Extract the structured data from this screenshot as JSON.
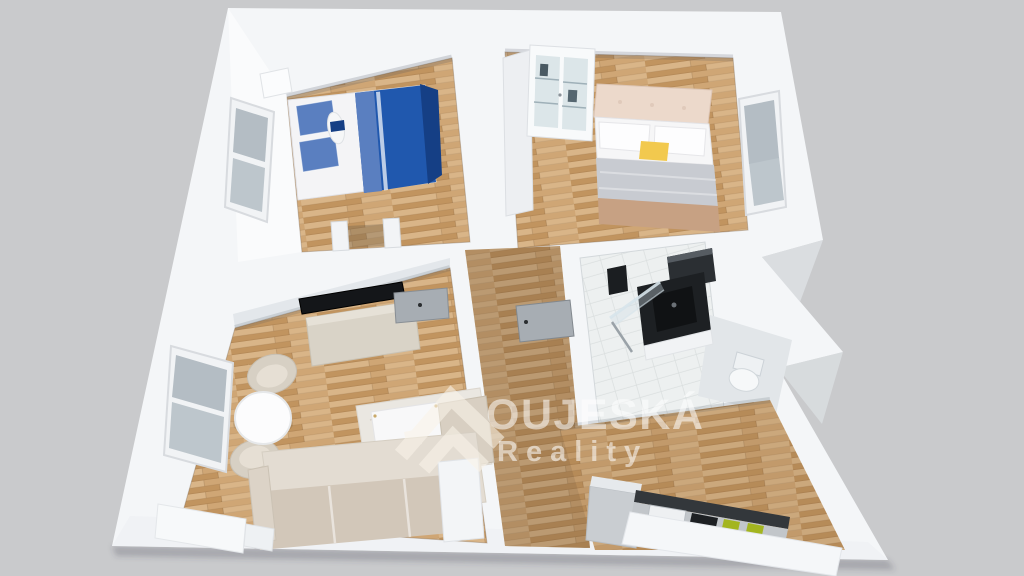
{
  "meta": {
    "kind": "real-estate 3d floor plan render",
    "view": "dollhouse top-down perspective, slightly rotated"
  },
  "watermark": {
    "brand": "OUJESKÁ",
    "tagline": "Reality",
    "logo": "double-roof-chevron-with-square",
    "color": "#ffffff",
    "opacity": 0.55
  },
  "palette": {
    "bg": "#c9cacc",
    "shell": "#f4f6f8",
    "wallShade": "#dfe3e7",
    "woodA": "#cfa675",
    "woodB": "#c1945f",
    "woodC": "#d9b588",
    "tile": "#edf0f0",
    "tileLine": "#d9dede",
    "white": "#fafbfc",
    "dark": "#1d2023",
    "blueDuvet": "#2058ae",
    "blueNavy": "#153f85",
    "plaid": "#5a7fc0",
    "beigeHead": "#ecd9cb",
    "grayDuvet": "#c8cbd1",
    "tanThrow": "#c7a183",
    "yellow": "#f2c94e",
    "sofa": "#d2c7b9",
    "sofaLight": "#e3dcd2",
    "stone": "#d9d3c7",
    "green": "#a3b520",
    "glass": "#b4bdc4",
    "door": "#a7adb3",
    "rug": "#eae7e1",
    "wmColor": "#faf4e9"
  },
  "apartment": {
    "rooms": [
      {
        "id": "bedroom-small",
        "floor": "wood",
        "furniture": [
          "single-bed-blue-duvet",
          "plaid-pillows",
          "nightstand",
          "window-left-wall",
          "closet-partitions"
        ]
      },
      {
        "id": "bedroom-master",
        "floor": "wood",
        "furniture": [
          "double-bed-beige-headboard",
          "gray-duvet",
          "tan-foot-throw",
          "yellow-accent-pillow",
          "glass-display-cabinet",
          "wardrobe-column",
          "window-right-wall"
        ]
      },
      {
        "id": "bathroom",
        "floor": "white-tile",
        "furniture": [
          "black-vanity-sink",
          "black-wall-cabinet",
          "shower-glass-panel",
          "shower-head",
          "shower-rail"
        ]
      },
      {
        "id": "wc",
        "floor": "gray",
        "furniture": [
          "toilet"
        ]
      },
      {
        "id": "hallway",
        "floor": "wood",
        "furniture": [
          "bathroom-door"
        ]
      },
      {
        "id": "living-room",
        "floor": "wood",
        "furniture": [
          "corner-sofa",
          "coffee-table",
          "rug",
          "round-dining-table",
          "armchair-north",
          "armchair-south",
          "tv-flatscreen",
          "stone-tv-sideboard",
          "window-left-wall",
          "storage-chest",
          "interior-door",
          "side-cabinet"
        ]
      },
      {
        "id": "kitchen",
        "floor": "wood",
        "furniture": [
          "fridge",
          "dark-backsplash",
          "microwave",
          "cooktop",
          "green-accents",
          "white-counter"
        ]
      }
    ]
  }
}
